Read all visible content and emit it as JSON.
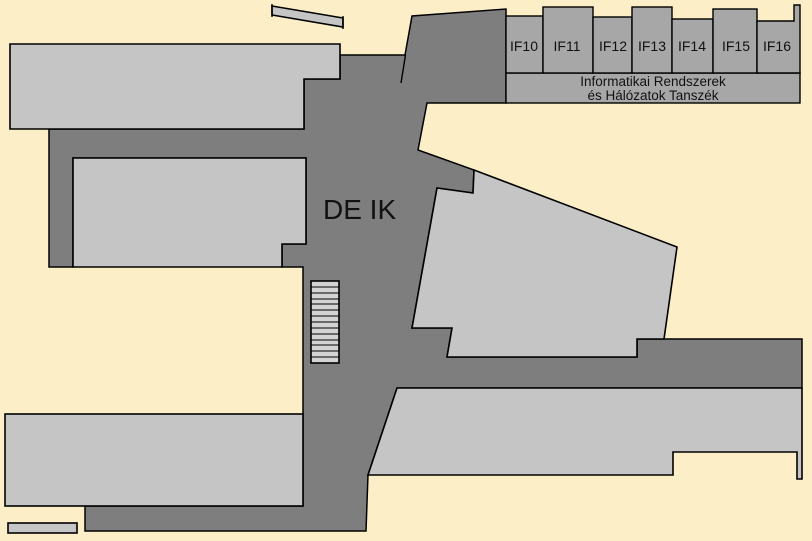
{
  "floor_plan": {
    "building_label": "DE IK",
    "department": {
      "line1": "Informatikai Rendszerek",
      "line2": "és Hálózatok Tanszék"
    },
    "rooms": [
      {
        "label": "IF10"
      },
      {
        "label": "IF11"
      },
      {
        "label": "IF12"
      },
      {
        "label": "IF13"
      },
      {
        "label": "IF14"
      },
      {
        "label": "IF15"
      },
      {
        "label": "IF16"
      }
    ]
  },
  "colors": {
    "background": "#FCEEC7",
    "corridor": "#7E7E7E",
    "room": "#C5C5C5",
    "office": "#A7A7A7",
    "stairs": "#D3D3D3",
    "outline": "#000000",
    "label": "#111111"
  }
}
